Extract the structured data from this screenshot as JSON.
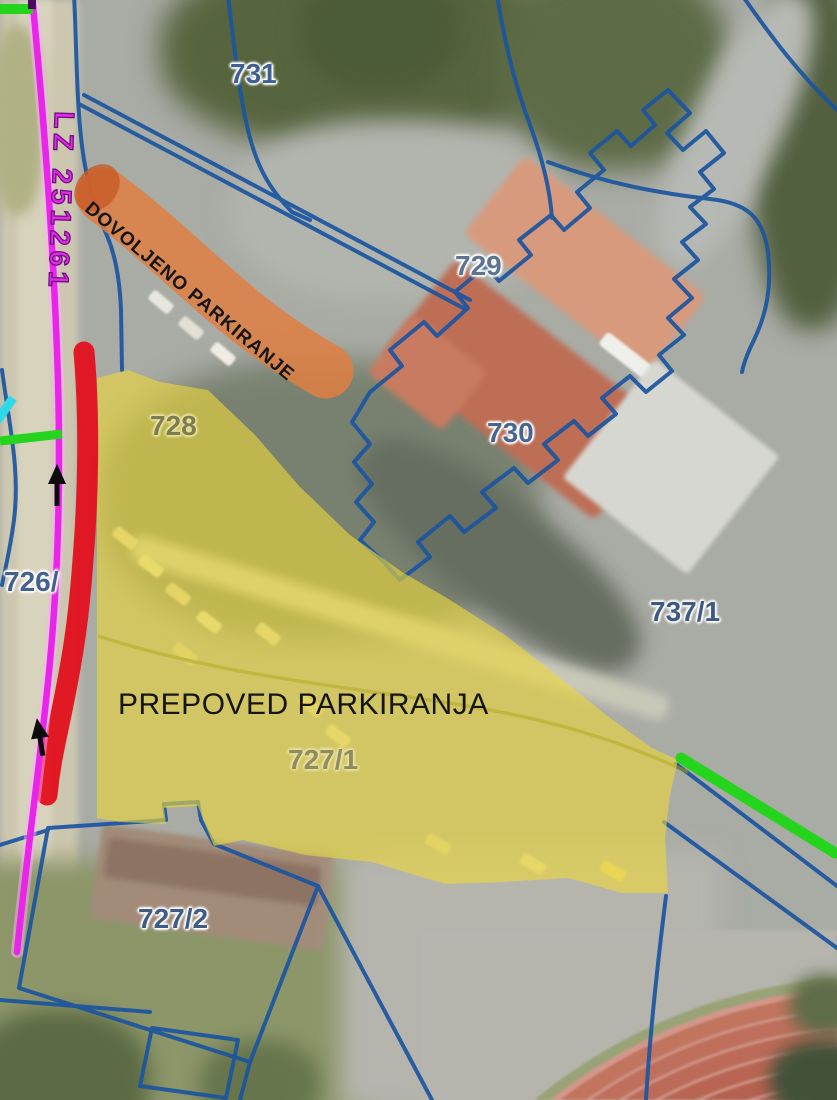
{
  "map": {
    "road_label": "LZ 251261",
    "zones": {
      "allowed": {
        "label": "DOVOLJENO PARKIRANJE",
        "color": "#df7f42"
      },
      "forbidden": {
        "label": "PREPOVED PARKIRANJA",
        "color": "#ecd63b"
      },
      "restricted_edge": {
        "color": "#e2121f"
      }
    },
    "parcels": [
      {
        "label": "731"
      },
      {
        "label": "729"
      },
      {
        "label": "728"
      },
      {
        "label": "730"
      },
      {
        "label": "737/1"
      },
      {
        "label": "726/"
      },
      {
        "label": "727/1"
      },
      {
        "label": "727/2"
      }
    ],
    "colors": {
      "cadastral_boundary": "#1b55a0",
      "road_line": "#ea25ea",
      "path_marking_green": "#25d41c",
      "cyan_marking": "#2fd9e8",
      "parcel_label": "#47658f"
    }
  }
}
